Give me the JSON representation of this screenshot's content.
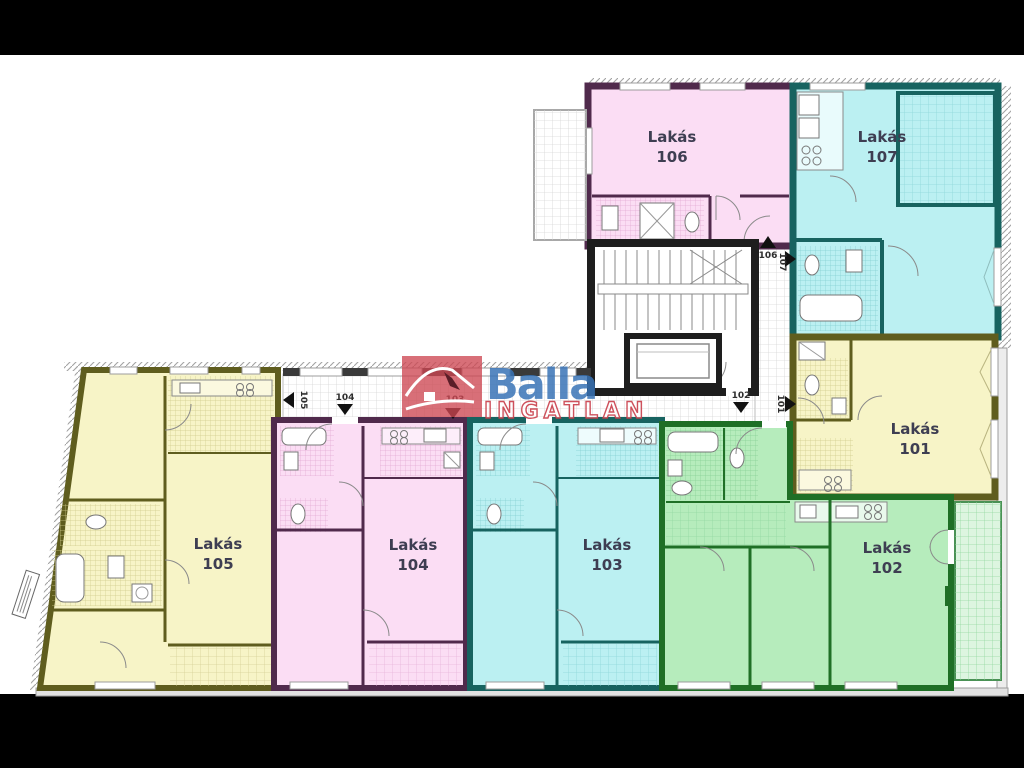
{
  "page": {
    "background": "#000000",
    "sheet_background": "#ffffff",
    "description": "Apartment building floor plan with seven flats (Lakás 101-107), central staircase with elevator, corridors, balconies and Balla Ingatlan watermark"
  },
  "logo": {
    "brand": "Balla",
    "subtitle": "INGATLAN",
    "brand_color": "#3873b6",
    "accent_color": "#cd4652",
    "icon": "house-roof-icon"
  },
  "apartments": [
    {
      "number": "101",
      "name": "Lakás",
      "fill": "#f7f4c7",
      "wall": "#5f5d1e"
    },
    {
      "number": "102",
      "name": "Lakás",
      "fill": "#b6ecbc",
      "wall": "#1f6f26"
    },
    {
      "number": "103",
      "name": "Lakás",
      "fill": "#bbf0f2",
      "wall": "#176360"
    },
    {
      "number": "104",
      "name": "Lakás",
      "fill": "#fbddf4",
      "wall": "#502a4c"
    },
    {
      "number": "105",
      "name": "Lakás",
      "fill": "#f7f4c7",
      "wall": "#5f5d1e"
    },
    {
      "number": "106",
      "name": "Lakás",
      "fill": "#fbddf4",
      "wall": "#502a4c"
    },
    {
      "number": "107",
      "name": "Lakás",
      "fill": "#bbf0f2",
      "wall": "#176360"
    }
  ],
  "door_labels": {
    "d101": "101",
    "d102": "102",
    "d103": "103",
    "d104": "104",
    "d105": "105",
    "d106": "106",
    "d107": "107"
  }
}
